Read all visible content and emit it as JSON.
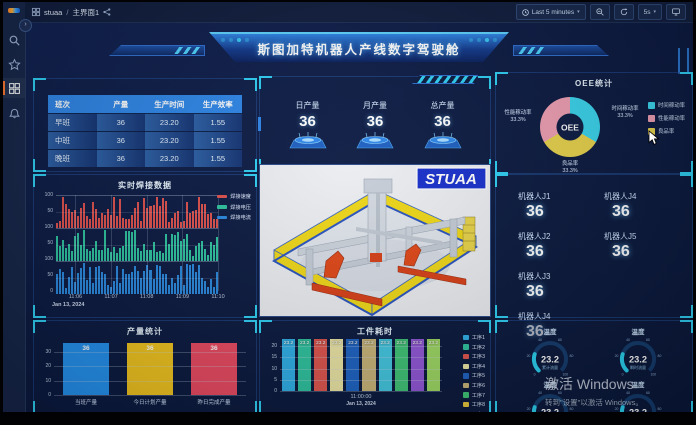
{
  "chrome": {
    "breadcrumb_app": "stuaa",
    "breadcrumb_sep": "/",
    "breadcrumb_page": "主界面1",
    "time_range": "Last 5 minutes",
    "refresh": "5s"
  },
  "banner": {
    "title": "斯图加特机器人产线数字驾驶舱"
  },
  "shift_table": {
    "headers": [
      "班次",
      "产量",
      "生产时间",
      "生产效率"
    ],
    "rows": [
      [
        "早班",
        "36",
        "23.20",
        "1.55"
      ],
      [
        "中班",
        "36",
        "23.20",
        "1.55"
      ],
      [
        "晚班",
        "36",
        "23.20",
        "1.55"
      ]
    ]
  },
  "stat_cards": [
    {
      "label": "日产量",
      "value": "36"
    },
    {
      "label": "月产量",
      "value": "36"
    },
    {
      "label": "总产量",
      "value": "36"
    }
  ],
  "oee": {
    "title": "OEE统计",
    "center_label": "OEE",
    "slices": [
      {
        "label": "时间稼动率",
        "pct": "33.3%",
        "value": 33.3,
        "color": "#3ad6ef"
      },
      {
        "label": "良品率",
        "pct": "33.3%",
        "value": 33.3,
        "color": "#e9d44d"
      },
      {
        "label": "性能稼动率",
        "pct": "33.3%",
        "value": 33.3,
        "color": "#efa0b4"
      }
    ],
    "legend": [
      {
        "label": "时间稼动率",
        "color": "#3ad6ef"
      },
      {
        "label": "性能稼动率",
        "color": "#efa0b4"
      },
      {
        "label": "良品率",
        "color": "#e9d44d"
      }
    ]
  },
  "welding": {
    "title": "实时焊接数据",
    "series": [
      {
        "name": "焊接速度",
        "color": "#e0524e"
      },
      {
        "name": "焊接电压",
        "color": "#2ec4a0"
      },
      {
        "name": "焊接电流",
        "color": "#2a8ae0"
      }
    ],
    "y_ticks": [
      "100",
      "50"
    ],
    "y_base": "0",
    "x_ticks": [
      "11:06",
      "11:07",
      "11:08",
      "11:09",
      "11:10"
    ],
    "date": "Jan 13, 2024"
  },
  "model_viewer": {
    "logo": "STUAA"
  },
  "robots": {
    "col1": [
      {
        "label": "机器人J1",
        "value": "36"
      },
      {
        "label": "机器人J2",
        "value": "36"
      },
      {
        "label": "机器人J3",
        "value": "36"
      },
      {
        "label": "机器人J4",
        "value": "36"
      }
    ],
    "col2": [
      {
        "label": "机器人J4",
        "value": "36"
      },
      {
        "label": "机器人J5",
        "value": "36"
      }
    ]
  },
  "production_stats": {
    "title": "产量统计",
    "y_max": 36,
    "y_ticks": [
      "30",
      "20",
      "10",
      "0"
    ],
    "bars": [
      {
        "label": "当班产量",
        "value": "36",
        "color": "#2492f0"
      },
      {
        "label": "今日计划产量",
        "value": "36",
        "color": "#f2c51f"
      },
      {
        "label": "昨日完成产量",
        "value": "36",
        "color": "#ea4a62"
      }
    ]
  },
  "workpiece": {
    "title": "工件耗时",
    "y_max": 23.2,
    "y_ticks": [
      "20",
      "15",
      "10",
      "5",
      "0"
    ],
    "x_tick": "11:00:00",
    "date": "Jan 13, 2024",
    "bars": [
      {
        "value": "23.2",
        "color": "#2fb0e8"
      },
      {
        "value": "23.2",
        "color": "#2ec4a0"
      },
      {
        "value": "23.2",
        "color": "#e0554e"
      },
      {
        "value": "23.2",
        "color": "#ede6a6"
      },
      {
        "value": "23.2",
        "color": "#1d63c4"
      },
      {
        "value": "23.2",
        "color": "#c9b579"
      },
      {
        "value": "23.2",
        "color": "#43c8e2"
      },
      {
        "value": "23.2",
        "color": "#3fc477"
      },
      {
        "value": "23.2",
        "color": "#9257d8"
      },
      {
        "value": "23.2",
        "color": "#9ed963"
      }
    ],
    "legend": [
      {
        "label": "工序1",
        "color": "#2fb0e8"
      },
      {
        "label": "工序2",
        "color": "#2ec4a0"
      },
      {
        "label": "工序3",
        "color": "#e0554e"
      },
      {
        "label": "工序4",
        "color": "#ede6a6"
      },
      {
        "label": "工序5",
        "color": "#1d63c4"
      },
      {
        "label": "工序6",
        "color": "#c9b579"
      },
      {
        "label": "工序7",
        "color": "#3fc477"
      },
      {
        "label": "工序8",
        "color": "#e8c93e"
      },
      {
        "label": "工序9",
        "color": "#9257d8"
      }
    ]
  },
  "gauges": {
    "ticks": [
      "0",
      "20",
      "40",
      "60",
      "80",
      "100"
    ],
    "min": 0,
    "max": 100,
    "items": [
      {
        "title": "温度",
        "value": "23.2",
        "sub": "累计流量"
      },
      {
        "title": "温度",
        "value": "23.2",
        "sub": "瞬时流量"
      },
      {
        "title": "温度",
        "value": "23.2",
        "sub": ""
      },
      {
        "title": "温度",
        "value": "23.2",
        "sub": ""
      }
    ]
  },
  "watermark": {
    "line1": "激活 Windows",
    "line2": "转到\"设置\"以激活 Windows。"
  }
}
